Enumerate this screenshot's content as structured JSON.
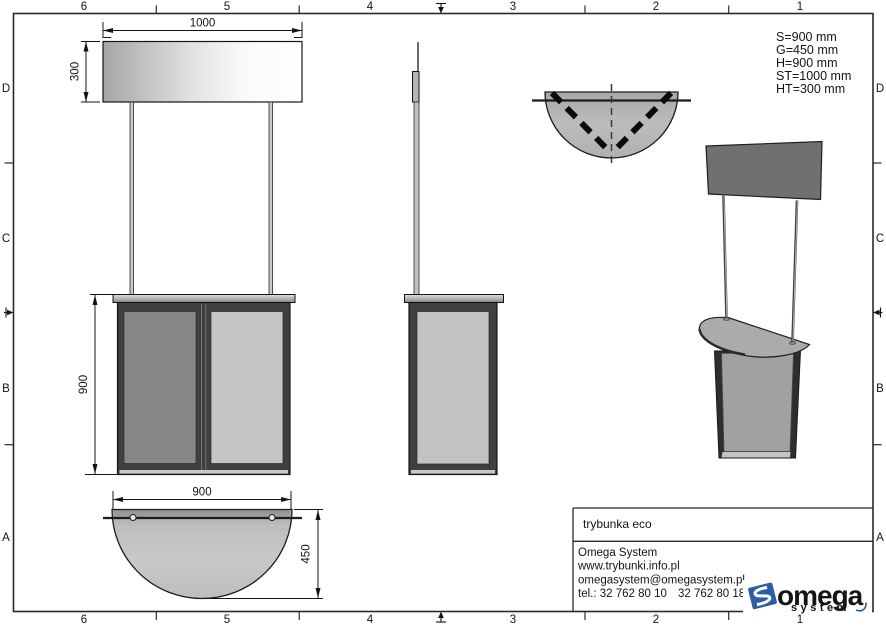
{
  "drawing": {
    "type": "technical-drawing",
    "product_name": "trybunka eco",
    "views": [
      "front-view",
      "side-view",
      "top-plan-view",
      "base-plan-view",
      "perspective-view"
    ]
  },
  "grid": {
    "cols": [
      "6",
      "5",
      "4",
      "3",
      "2",
      "1"
    ],
    "rows": [
      "D",
      "C",
      "B",
      "A"
    ]
  },
  "specs": {
    "lines": [
      "S=900 mm",
      "G=450 mm",
      "H=900 mm",
      "ST=1000 mm",
      "HT=300 mm"
    ]
  },
  "dimensions": {
    "header_width": "1000",
    "header_height": "300",
    "body_height": "900",
    "base_width": "900",
    "base_depth": "450"
  },
  "title_block": {
    "product": "trybunka eco",
    "company": "Omega System",
    "website": "www.trybunki.info.pl",
    "email": "omegasystem@omegasystem.pl",
    "phone1": "tel.: 32 762 80 10",
    "phone2": "32 762 80 18"
  },
  "logo": {
    "text": "omega",
    "subtext": "system",
    "blue": "#2d5da7",
    "gray": "#9b9b9b"
  },
  "colors": {
    "line": "#1a1a1a",
    "panel_dark": "#858585",
    "panel_light": "#c5c5c5",
    "frame_dark": "#3f3f3f",
    "header_3d": "#707070",
    "accent_blue": "#2d5da7"
  }
}
